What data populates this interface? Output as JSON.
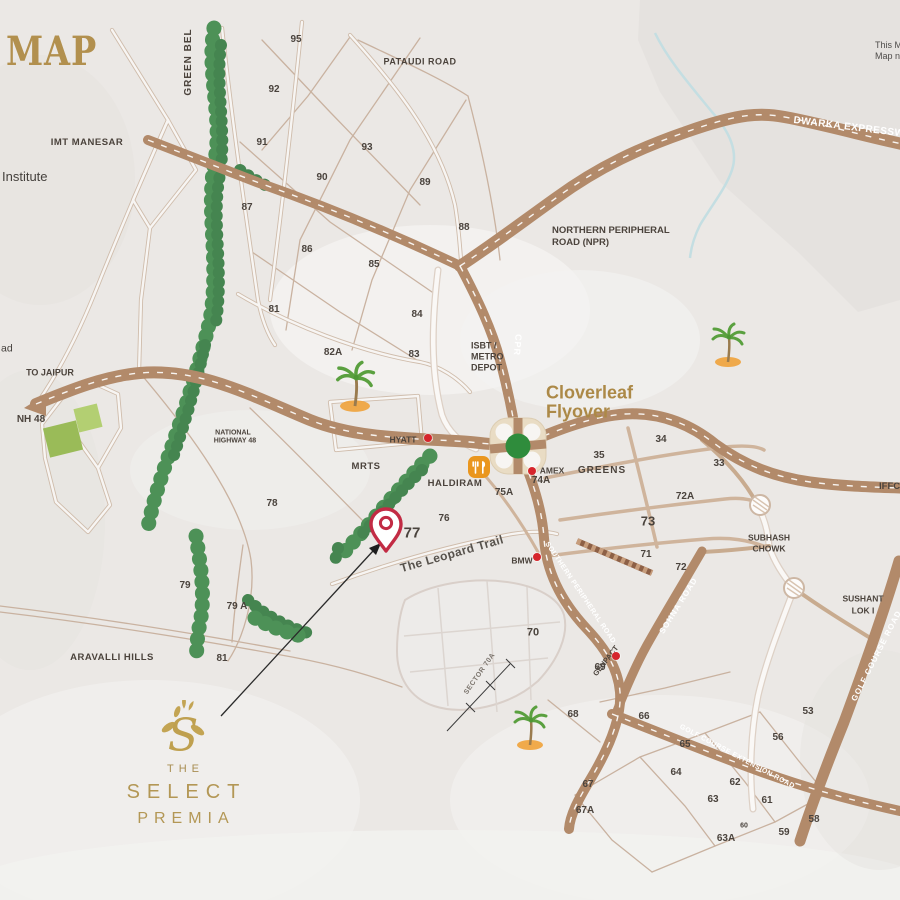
{
  "title": {
    "text": "MAP"
  },
  "disclaimer": {
    "line1": "This M",
    "line2": "Map n"
  },
  "logo": {
    "the": "THE",
    "select": "SELECT",
    "premia": "PREMIA"
  },
  "colors": {
    "accent_gold": "#ac8947",
    "road_tan": "#b28a6a",
    "tree_green": "#4d9157",
    "pin_red": "#c22b44",
    "landmark_dot_red": "#d6252c",
    "interchange_green": "#2f8c3c",
    "background": "#ebe8e5"
  },
  "labels": [
    {
      "n": "green-belt-label",
      "t": "GREEN BEL",
      "x": 189,
      "y": 62,
      "rot": -90,
      "fs": 10,
      "c": "d ls1"
    },
    {
      "n": "pataudi-road-label",
      "t": "PATAUDI ROAD",
      "x": 420,
      "y": 62,
      "fs": 9,
      "c": "d ls05"
    },
    {
      "n": "imt-manesar-label",
      "t": "IMT MANESAR",
      "x": 87,
      "y": 143,
      "fs": 9.5,
      "c": "d ls05"
    },
    {
      "n": "institute-label",
      "t": "Institute",
      "x": 2,
      "y": 177,
      "fs": 13,
      "a": "l",
      "c": "n"
    },
    {
      "n": "road-edge-fragment",
      "t": "ad",
      "x": 1,
      "y": 349,
      "fs": 10.5,
      "a": "l",
      "c": "n"
    },
    {
      "n": "to-jaipur-label",
      "t": "TO JAIPUR",
      "x": 50,
      "y": 373,
      "fs": 9,
      "c": "d"
    },
    {
      "n": "nh48-label",
      "t": "NH 48",
      "x": 31,
      "y": 420,
      "fs": 10,
      "c": "d"
    },
    {
      "n": "national-highway-48-line1",
      "t": "NATIONAL",
      "x": 233,
      "y": 433,
      "fs": 7,
      "c": "d"
    },
    {
      "n": "national-highway-48-line2",
      "t": "HIGHWAY 48",
      "x": 235,
      "y": 441,
      "fs": 7,
      "c": "d"
    },
    {
      "n": "npr-label-line1",
      "t": "NORTHERN PERIPHERAL",
      "x": 552,
      "y": 231,
      "fs": 9.5,
      "a": "l",
      "c": "d"
    },
    {
      "n": "npr-label-line2",
      "t": "ROAD (NPR)",
      "x": 552,
      "y": 243,
      "fs": 9.5,
      "a": "l",
      "c": "d"
    },
    {
      "n": "dwarka-expressway-label",
      "t": "DWARKA EXPRESSW",
      "x": 793,
      "y": 128,
      "rot": 7,
      "fs": 10,
      "a": "l",
      "c": "w ls05"
    },
    {
      "n": "isbt-metro-depot-line1",
      "t": "ISBT /",
      "x": 471,
      "y": 346,
      "fs": 9,
      "a": "l",
      "c": "d"
    },
    {
      "n": "isbt-metro-depot-line2",
      "t": "METRO",
      "x": 471,
      "y": 357,
      "fs": 9,
      "a": "l",
      "c": "d"
    },
    {
      "n": "isbt-metro-depot-line3",
      "t": "DEPOT",
      "x": 471,
      "y": 368,
      "fs": 9,
      "a": "l",
      "c": "d"
    },
    {
      "n": "cpr-label",
      "t": "CPR",
      "x": 517,
      "y": 345,
      "rot": 95,
      "fs": 9,
      "c": "w ls1"
    },
    {
      "n": "cloverleaf-flyover-line1",
      "t": "Cloverleaf",
      "x": 546,
      "y": 393,
      "fs": 18,
      "a": "l",
      "c": "g"
    },
    {
      "n": "cloverleaf-flyover-line2",
      "t": "Flyover",
      "x": 546,
      "y": 412,
      "fs": 18,
      "a": "l",
      "c": "g"
    },
    {
      "n": "hyatt-label",
      "t": "HYATT",
      "x": 403,
      "y": 440,
      "fs": 8.5,
      "c": "d"
    },
    {
      "n": "mrts-label",
      "t": "MRTS",
      "x": 366,
      "y": 467,
      "fs": 9.5,
      "c": "d ls05"
    },
    {
      "n": "haldiram-label",
      "t": "HALDIRAM",
      "x": 455,
      "y": 484,
      "fs": 9.5,
      "c": "d ls05"
    },
    {
      "n": "amex-label",
      "t": "AMEX",
      "x": 552,
      "y": 471,
      "fs": 8.5,
      "c": "d"
    },
    {
      "n": "greens-label",
      "t": "GREENS",
      "x": 602,
      "y": 471,
      "fs": 10,
      "c": "d ls1"
    },
    {
      "n": "subhash-chowk-line1",
      "t": "SUBHASH",
      "x": 769,
      "y": 538,
      "fs": 8.5,
      "c": "d"
    },
    {
      "n": "subhash-chowk-line2",
      "t": "CHOWK",
      "x": 769,
      "y": 549,
      "fs": 8.5,
      "c": "d"
    },
    {
      "n": "sushant-lok-line1",
      "t": "SUSHANT",
      "x": 863,
      "y": 599,
      "fs": 8.5,
      "c": "d"
    },
    {
      "n": "sushant-lok-line2",
      "t": "LOK I",
      "x": 863,
      "y": 611,
      "fs": 8.5,
      "c": "d"
    },
    {
      "n": "iffco-chowk-label",
      "t": "IFFCO C",
      "x": 879,
      "y": 487,
      "fs": 9.5,
      "a": "l",
      "c": "d"
    },
    {
      "n": "golf-course-road-label",
      "t": "GOLF COURSE ROAD",
      "x": 877,
      "y": 656,
      "rot": -63,
      "fs": 8,
      "c": "w ls1"
    },
    {
      "n": "sohna-road-label",
      "t": "SOHNA ROAD",
      "x": 679,
      "y": 606,
      "rot": -58,
      "fs": 8,
      "c": "w ls1"
    },
    {
      "n": "genpact-label",
      "t": "GENPACT",
      "x": 606,
      "y": 661,
      "rot": -52,
      "fs": 7.5,
      "c": "d"
    },
    {
      "n": "leopard-trail-label",
      "t": "The Leopard Trail",
      "x": 452,
      "y": 554,
      "rot": -16,
      "fs": 12,
      "c": "m"
    },
    {
      "n": "spr-label",
      "t": "SOUTHERN PERIPHERAL ROAD",
      "x": 580,
      "y": 593,
      "rot": 56,
      "fs": 7,
      "c": "w ls05"
    },
    {
      "n": "golf-course-ext-label",
      "t": "GOLF COURSE EXTENSION ROAD",
      "x": 737,
      "y": 757,
      "rot": 28,
      "fs": 7,
      "c": "w ls05"
    },
    {
      "n": "aravalli-hills-label",
      "t": "ARAVALLI HILLS",
      "x": 112,
      "y": 658,
      "fs": 9.5,
      "c": "d ls05"
    },
    {
      "n": "sector-70a-label",
      "t": "SECTOR 70A",
      "x": 480,
      "y": 674,
      "rot": -55,
      "fs": 7,
      "c": "s ls05"
    },
    {
      "n": "bmw-label",
      "t": "BMW",
      "x": 522,
      "y": 561,
      "fs": 8.5,
      "c": "d"
    }
  ],
  "sectors": [
    {
      "t": "95",
      "x": 296,
      "y": 40
    },
    {
      "t": "92",
      "x": 274,
      "y": 90
    },
    {
      "t": "91",
      "x": 262,
      "y": 143
    },
    {
      "t": "93",
      "x": 367,
      "y": 148
    },
    {
      "t": "90",
      "x": 322,
      "y": 178
    },
    {
      "t": "89",
      "x": 425,
      "y": 183
    },
    {
      "t": "87",
      "x": 247,
      "y": 208
    },
    {
      "t": "88",
      "x": 464,
      "y": 228
    },
    {
      "t": "86",
      "x": 307,
      "y": 250
    },
    {
      "t": "85",
      "x": 374,
      "y": 265
    },
    {
      "t": "81",
      "x": 274,
      "y": 310
    },
    {
      "t": "84",
      "x": 417,
      "y": 315
    },
    {
      "t": "82A",
      "x": 333,
      "y": 353
    },
    {
      "t": "83",
      "x": 414,
      "y": 355
    },
    {
      "t": "78",
      "x": 272,
      "y": 504
    },
    {
      "t": "76",
      "x": 444,
      "y": 519
    },
    {
      "t": "77",
      "x": 412,
      "y": 533,
      "fs": 15
    },
    {
      "t": "75A",
      "x": 504,
      "y": 493
    },
    {
      "t": "74A",
      "x": 541,
      "y": 481
    },
    {
      "t": "35",
      "x": 599,
      "y": 456
    },
    {
      "t": "34",
      "x": 661,
      "y": 440
    },
    {
      "t": "33",
      "x": 719,
      "y": 464
    },
    {
      "t": "72A",
      "x": 685,
      "y": 497
    },
    {
      "t": "73",
      "x": 648,
      "y": 521,
      "fs": 13
    },
    {
      "t": "71",
      "x": 646,
      "y": 555
    },
    {
      "t": "72",
      "x": 681,
      "y": 568
    },
    {
      "t": "79",
      "x": 185,
      "y": 586
    },
    {
      "t": "79 A",
      "x": 237,
      "y": 607
    },
    {
      "t": "81",
      "x": 222,
      "y": 659
    },
    {
      "t": "70",
      "x": 533,
      "y": 633,
      "fs": 11
    },
    {
      "t": "69",
      "x": 600,
      "y": 668
    },
    {
      "t": "68",
      "x": 573,
      "y": 715
    },
    {
      "t": "66",
      "x": 644,
      "y": 717
    },
    {
      "t": "65",
      "x": 685,
      "y": 745
    },
    {
      "t": "67",
      "x": 588,
      "y": 785
    },
    {
      "t": "67A",
      "x": 585,
      "y": 811
    },
    {
      "t": "64",
      "x": 676,
      "y": 773
    },
    {
      "t": "63",
      "x": 713,
      "y": 800
    },
    {
      "t": "62",
      "x": 735,
      "y": 783
    },
    {
      "t": "61",
      "x": 767,
      "y": 801
    },
    {
      "t": "60",
      "x": 744,
      "y": 826,
      "fs": 7
    },
    {
      "t": "59",
      "x": 784,
      "y": 833
    },
    {
      "t": "63A",
      "x": 726,
      "y": 839
    },
    {
      "t": "58",
      "x": 814,
      "y": 820
    },
    {
      "t": "56",
      "x": 778,
      "y": 738
    },
    {
      "t": "53",
      "x": 808,
      "y": 712
    }
  ],
  "markers": [
    {
      "n": "hyatt-dot",
      "x": 428,
      "y": 438
    },
    {
      "n": "amex-dot",
      "x": 532,
      "y": 471
    },
    {
      "n": "bmw-dot",
      "x": 537,
      "y": 557
    },
    {
      "n": "genpact-dot",
      "x": 616,
      "y": 656
    }
  ]
}
